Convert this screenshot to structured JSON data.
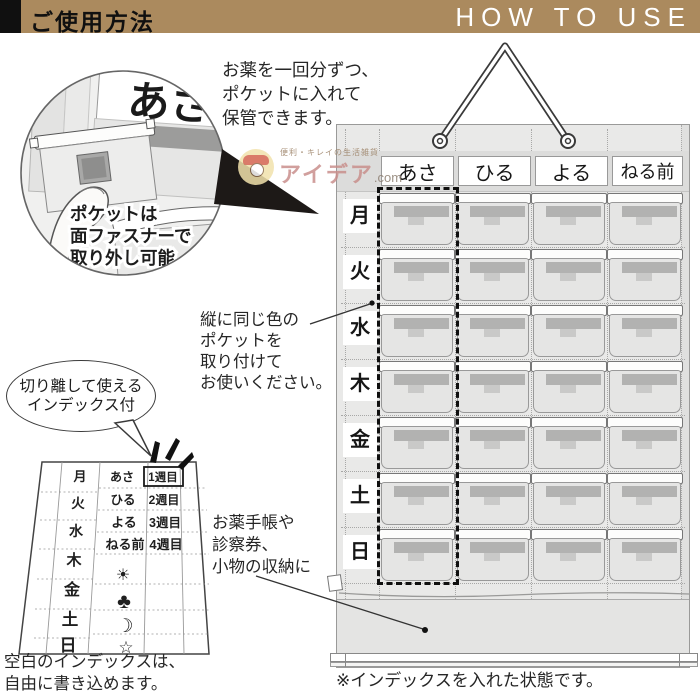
{
  "header": {
    "title_jp": "ご使用方法",
    "title_en": "HOW TO USE"
  },
  "notes": {
    "store": [
      "お薬を一回分ずつ、",
      "ポケットに入れて",
      "保管できます。"
    ],
    "pocket_removable": [
      "ポケットは",
      "面ファスナーで",
      "取り外し可能"
    ],
    "vertical_color": [
      "縦に同じ色の",
      "ポケットを",
      "取り付けて",
      "お使いください。"
    ],
    "bubble": [
      "切り離して使える",
      "インデックス付"
    ],
    "storage": [
      "お薬手帳や",
      "診察券、",
      "小物の収納に"
    ],
    "blank_index": [
      "空白のインデックスは、",
      "自由に書き込めます。"
    ],
    "state": "※インデックスを入れた状態です。"
  },
  "watermark": {
    "tagline": "便利・キレイの生活雑貨",
    "brand": "アイデア",
    "suffix": ".com"
  },
  "organizer": {
    "zoom_label": "あさ",
    "columns": [
      "あさ",
      "ひる",
      "よる",
      "ねる前"
    ],
    "rows": [
      "月",
      "火",
      "水",
      "木",
      "金",
      "土",
      "日"
    ]
  },
  "index_sheet": {
    "days": [
      "月",
      "火",
      "水",
      "木",
      "金",
      "土",
      "日"
    ],
    "times": [
      "あさ",
      "ひる",
      "よる",
      "ねる前"
    ],
    "weeks": [
      "1週目",
      "2週目",
      "3週目",
      "4週目"
    ],
    "symbols": [
      "☀",
      "♣",
      "☽",
      "☆"
    ]
  },
  "colors": {
    "accent_tan": "#ab8a5e",
    "panel_gray": "#e9e9e8",
    "pocket_gray": "#e5e5e4",
    "slot_dark": "#b2b2b1"
  }
}
